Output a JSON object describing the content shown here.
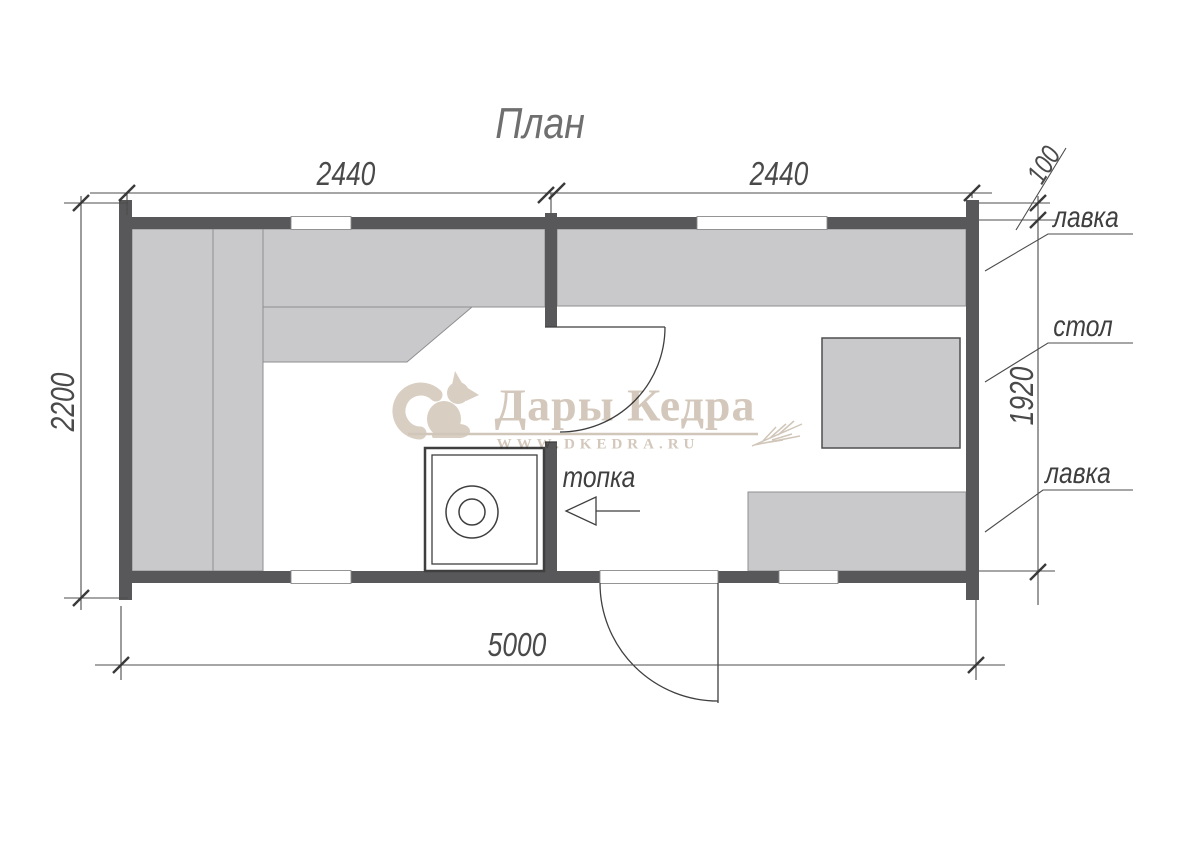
{
  "title": "План",
  "plan": {
    "labels": {
      "bench_top": "лавка",
      "table": "стол",
      "bench_bottom": "лавка",
      "furnace": "топка"
    },
    "dimensions": {
      "top_left": "2440",
      "top_right": "2440",
      "ledge_offset": "100",
      "left_height": "2200",
      "right_inner_height": "1920",
      "bottom_width": "5000"
    }
  },
  "watermark": {
    "brand": "Дары Кедра",
    "url": "WWW.DKEDRA.RU"
  },
  "colors": {
    "wall": "#58585a",
    "bench_fill": "#c9c9cb",
    "bench_stroke": "#8f8f91",
    "line": "#4c4c4c",
    "text": "#4a4a4a",
    "watermark": "#d3c8bb",
    "background": "#ffffff"
  }
}
